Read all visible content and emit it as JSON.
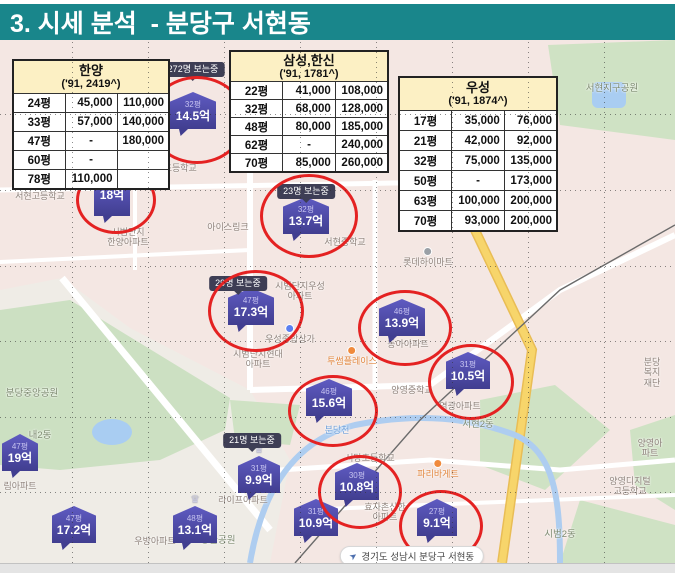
{
  "title": "3. 시세 분석  - 분당구 서현동",
  "colors": {
    "title_bg": "#19868b",
    "marker_blue_top": "#5f5bc2",
    "marker_blue_bottom": "#413e90",
    "highlight_red": "#e42222",
    "tooltip_bg": "#3e3e55",
    "table_header_bg": "#fcf0c4",
    "road_yellow": "#f6d36a",
    "park_green": "#cfe2c4",
    "water_blue": "#a9cdf2"
  },
  "tables": [
    {
      "name": "한양",
      "subtitle": "('91, 2419^)",
      "rows": [
        [
          "24평",
          "45,000",
          "110,000"
        ],
        [
          "33평",
          "57,000",
          "140,000"
        ],
        [
          "47평",
          "-",
          "180,000"
        ],
        [
          "60평",
          "-",
          ""
        ],
        [
          "78평",
          "110,000",
          ""
        ]
      ]
    },
    {
      "name": "삼성,한신",
      "subtitle": "('91, 1781^)",
      "rows": [
        [
          "22평",
          "41,000",
          "108,000"
        ],
        [
          "32평",
          "68,000",
          "128,000"
        ],
        [
          "48평",
          "80,000",
          "185,000"
        ],
        [
          "62평",
          "-",
          "240,000"
        ],
        [
          "70평",
          "85,000",
          "260,000"
        ]
      ]
    },
    {
      "name": "우성",
      "subtitle": "('91, 1874^)",
      "rows": [
        [
          "17평",
          "35,000",
          "76,000"
        ],
        [
          "21평",
          "42,000",
          "92,000"
        ],
        [
          "32평",
          "75,000",
          "135,000"
        ],
        [
          "50평",
          "-",
          "173,000"
        ],
        [
          "63평",
          "100,000",
          "200,000"
        ],
        [
          "70평",
          "93,000",
          "200,000"
        ]
      ]
    }
  ],
  "map": {
    "markers": [
      {
        "size": "32평",
        "price": "14.5억",
        "x": 170,
        "y": 92,
        "w": 46,
        "circle": [
          148,
          76,
          92,
          82
        ]
      },
      {
        "size": "",
        "price": "18억",
        "x": 94,
        "y": 179,
        "w": 36,
        "circle": [
          76,
          166,
          74,
          62
        ]
      },
      {
        "size": "32평",
        "price": "13.7억",
        "x": 283,
        "y": 197,
        "w": 46,
        "circle": [
          260,
          174,
          92,
          78
        ]
      },
      {
        "size": "47평",
        "price": "17.3억",
        "x": 228,
        "y": 288,
        "w": 46,
        "circle": [
          208,
          270,
          90,
          76
        ]
      },
      {
        "size": "46평",
        "price": "13.9억",
        "x": 379,
        "y": 299,
        "w": 46,
        "circle": [
          358,
          290,
          88,
          70
        ]
      },
      {
        "size": "31평",
        "price": "10.5억",
        "x": 446,
        "y": 352,
        "w": 44,
        "circle": [
          428,
          344,
          80,
          70
        ]
      },
      {
        "size": "46평",
        "price": "15.6억",
        "x": 306,
        "y": 379,
        "w": 46,
        "circle": [
          288,
          375,
          84,
          66
        ]
      },
      {
        "size": "30평",
        "price": "10.8억",
        "x": 335,
        "y": 463,
        "w": 44,
        "circle": [
          318,
          455,
          78,
          68
        ]
      },
      {
        "size": "27평",
        "price": "9.1억",
        "x": 417,
        "y": 499,
        "w": 40,
        "circle": [
          399,
          490,
          78,
          66
        ]
      },
      {
        "size": "31평",
        "price": "9.9억",
        "x": 238,
        "y": 456,
        "w": 42,
        "crown": true
      },
      {
        "size": "31평",
        "price": "10.9억",
        "x": 294,
        "y": 499,
        "w": 44
      },
      {
        "size": "48평",
        "price": "13.1억",
        "x": 173,
        "y": 506,
        "w": 44,
        "crown": true
      },
      {
        "size": "47평",
        "price": "19억",
        "x": 2,
        "y": 434,
        "w": 36
      },
      {
        "size": "47평",
        "price": "17.2억",
        "x": 52,
        "y": 506,
        "w": 44
      }
    ],
    "tooltips": [
      {
        "text": "272명 보는중",
        "x": 193,
        "y": 62
      },
      {
        "text": "23명 보는중",
        "x": 306,
        "y": 184
      },
      {
        "text": "29명 보는중",
        "x": 238,
        "y": 276
      },
      {
        "text": "21명 보는중",
        "x": 252,
        "y": 433
      }
    ],
    "labels": [
      {
        "text": "서현고등학교",
        "x": 40,
        "y": 191
      },
      {
        "text": "서현초등학교",
        "x": 172,
        "y": 163
      },
      {
        "text": "아이스링크",
        "x": 228,
        "y": 222
      },
      {
        "text": "시범단지\n한양아파트",
        "x": 128,
        "y": 227
      },
      {
        "text": "서현중학교",
        "x": 345,
        "y": 237
      },
      {
        "text": "롯데하이마트",
        "x": 428,
        "y": 247,
        "dot": "#9aa0a6"
      },
      {
        "text": "시범단지우성\n아파트",
        "x": 300,
        "y": 281
      },
      {
        "text": "우성종합상가",
        "x": 290,
        "y": 324,
        "dot": "#5b7ff0"
      },
      {
        "text": "시범단지현대\n아파트",
        "x": 258,
        "y": 349
      },
      {
        "text": "투썸플레이스",
        "x": 352,
        "y": 346,
        "style": "poi",
        "dot": "#f08a3c"
      },
      {
        "text": "동아아파트",
        "x": 408,
        "y": 339
      },
      {
        "text": "양영중학교",
        "x": 412,
        "y": 385
      },
      {
        "text": "염광아파트",
        "x": 460,
        "y": 401
      },
      {
        "text": "분당천",
        "x": 337,
        "y": 425,
        "style": "water"
      },
      {
        "text": "서현2동",
        "x": 478,
        "y": 420,
        "style": "dong"
      },
      {
        "text": "분당\n복지재단",
        "x": 652,
        "y": 357
      },
      {
        "text": "양영아파트",
        "x": 650,
        "y": 438
      },
      {
        "text": "파리바게트",
        "x": 438,
        "y": 459,
        "style": "poi",
        "dot": "#f08a3c"
      },
      {
        "text": "서당초등학교",
        "x": 370,
        "y": 453
      },
      {
        "text": "효자촌신한\n아파트",
        "x": 385,
        "y": 502
      },
      {
        "text": "라이프아파트",
        "x": 243,
        "y": 495
      },
      {
        "text": "양영디지털\n고등학교",
        "x": 630,
        "y": 476
      },
      {
        "text": "시범2동",
        "x": 560,
        "y": 530,
        "style": "dong"
      },
      {
        "text": "내2동",
        "x": 40,
        "y": 431,
        "style": "dong"
      },
      {
        "text": "분당중앙공원",
        "x": 32,
        "y": 389,
        "style": "dong"
      },
      {
        "text": "림아파트",
        "x": 20,
        "y": 481
      },
      {
        "text": "우방아파트",
        "x": 155,
        "y": 536
      },
      {
        "text": "당골공원",
        "x": 218,
        "y": 536,
        "style": "dong"
      },
      {
        "text": "서현지구공원",
        "x": 612,
        "y": 84,
        "style": "dong"
      }
    ]
  },
  "location_chip": {
    "text": "경기도 성남시 분당구 서현동"
  }
}
